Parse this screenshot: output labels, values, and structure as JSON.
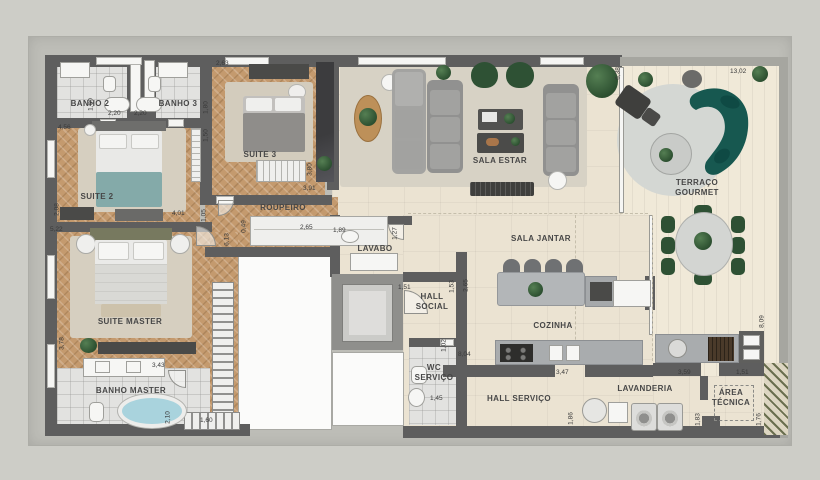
{
  "plan_title": "Floor plan (apartment)",
  "rooms": {
    "banho2": "BANHO 2",
    "banho3": "BANHO 3",
    "suite3": "SUITE 3",
    "suite2": "SUITE 2",
    "roupeiro": "ROUPEIRO",
    "suiteMaster": "SUITE MASTER",
    "banhoMaster": "BANHO MASTER",
    "lavabo": "LAVABO",
    "hallSocial": "HALL SOCIAL",
    "wcServico": "WC SERVIÇO",
    "salaEstar": "SALA ESTAR",
    "terracoGourmet": "TERRAÇO GOURMET",
    "salaJantar": "SALA JANTAR",
    "cozinha": "COZINHA",
    "hallServico": "HALL SERVIÇO",
    "lavanderia": "LAVANDERIA",
    "areaTecnica": "ÁREA TÉCNICA"
  },
  "dims": {
    "d01": "1,60",
    "d02": "2,20",
    "d03": "2,20",
    "d04": "4,56",
    "d05": "1,80",
    "d06": "2,63",
    "d07": "1,50",
    "d08": "3,80",
    "d09": "3,91",
    "d10": "0,49",
    "d11": "2,65",
    "d12": "6,13",
    "d13": "2,08",
    "d14": "4,01",
    "d15": "1,05",
    "d16": "5,22",
    "d17": "3,78",
    "d18": "3,43",
    "d19": "2,10",
    "d20": "1,60",
    "d21": "1,89",
    "d22": "1,27",
    "d23": "1,51",
    "d24": "1,53",
    "d25": "2,65",
    "d26": "1,02",
    "d27": "1,45",
    "d28": "8,04",
    "d29": "3,47",
    "d30": "1,86",
    "d31": "3,59",
    "d32": "1,51",
    "d33": "1,83",
    "d34": "1,76",
    "d35": "6,38",
    "d36": "13,02",
    "d37": "8,09"
  },
  "colors": {
    "wall": "#5e5e5e",
    "wood_floor": "#c49a6e",
    "living_floor": "#ebe3d2",
    "terrace_floor": "#f0e9d8",
    "teal_sofa": "#175850",
    "green_chair": "#2e5134",
    "bed_accent_teal": "#84aaa9",
    "tub_water": "#a9d3dd"
  }
}
